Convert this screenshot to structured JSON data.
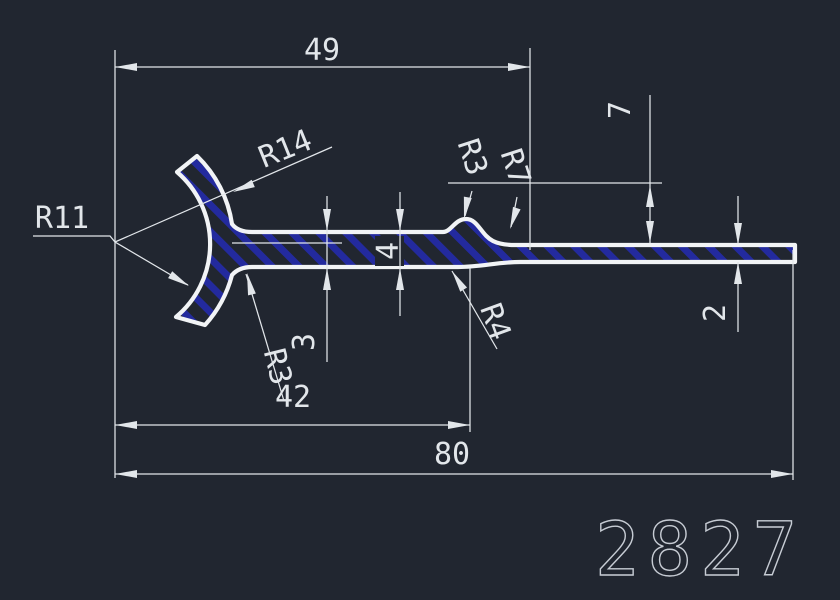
{
  "drawing_number": "2827",
  "labels": {
    "dim_49": "49",
    "dim_42": "42",
    "dim_80": "80",
    "dim_7": "7",
    "dim_4": "4",
    "dim_3": "3",
    "dim_2": "2",
    "r14": "R14",
    "r11": "R11",
    "r3_top": "R3",
    "r7": "R7",
    "r4": "R4",
    "r3_bottom": "R3"
  },
  "colors": {
    "background": "#212630",
    "geometry": "#f2f4f6",
    "dimension": "#e2e6ea",
    "hatch": "#232a9e",
    "number": "#c7ccd4"
  }
}
